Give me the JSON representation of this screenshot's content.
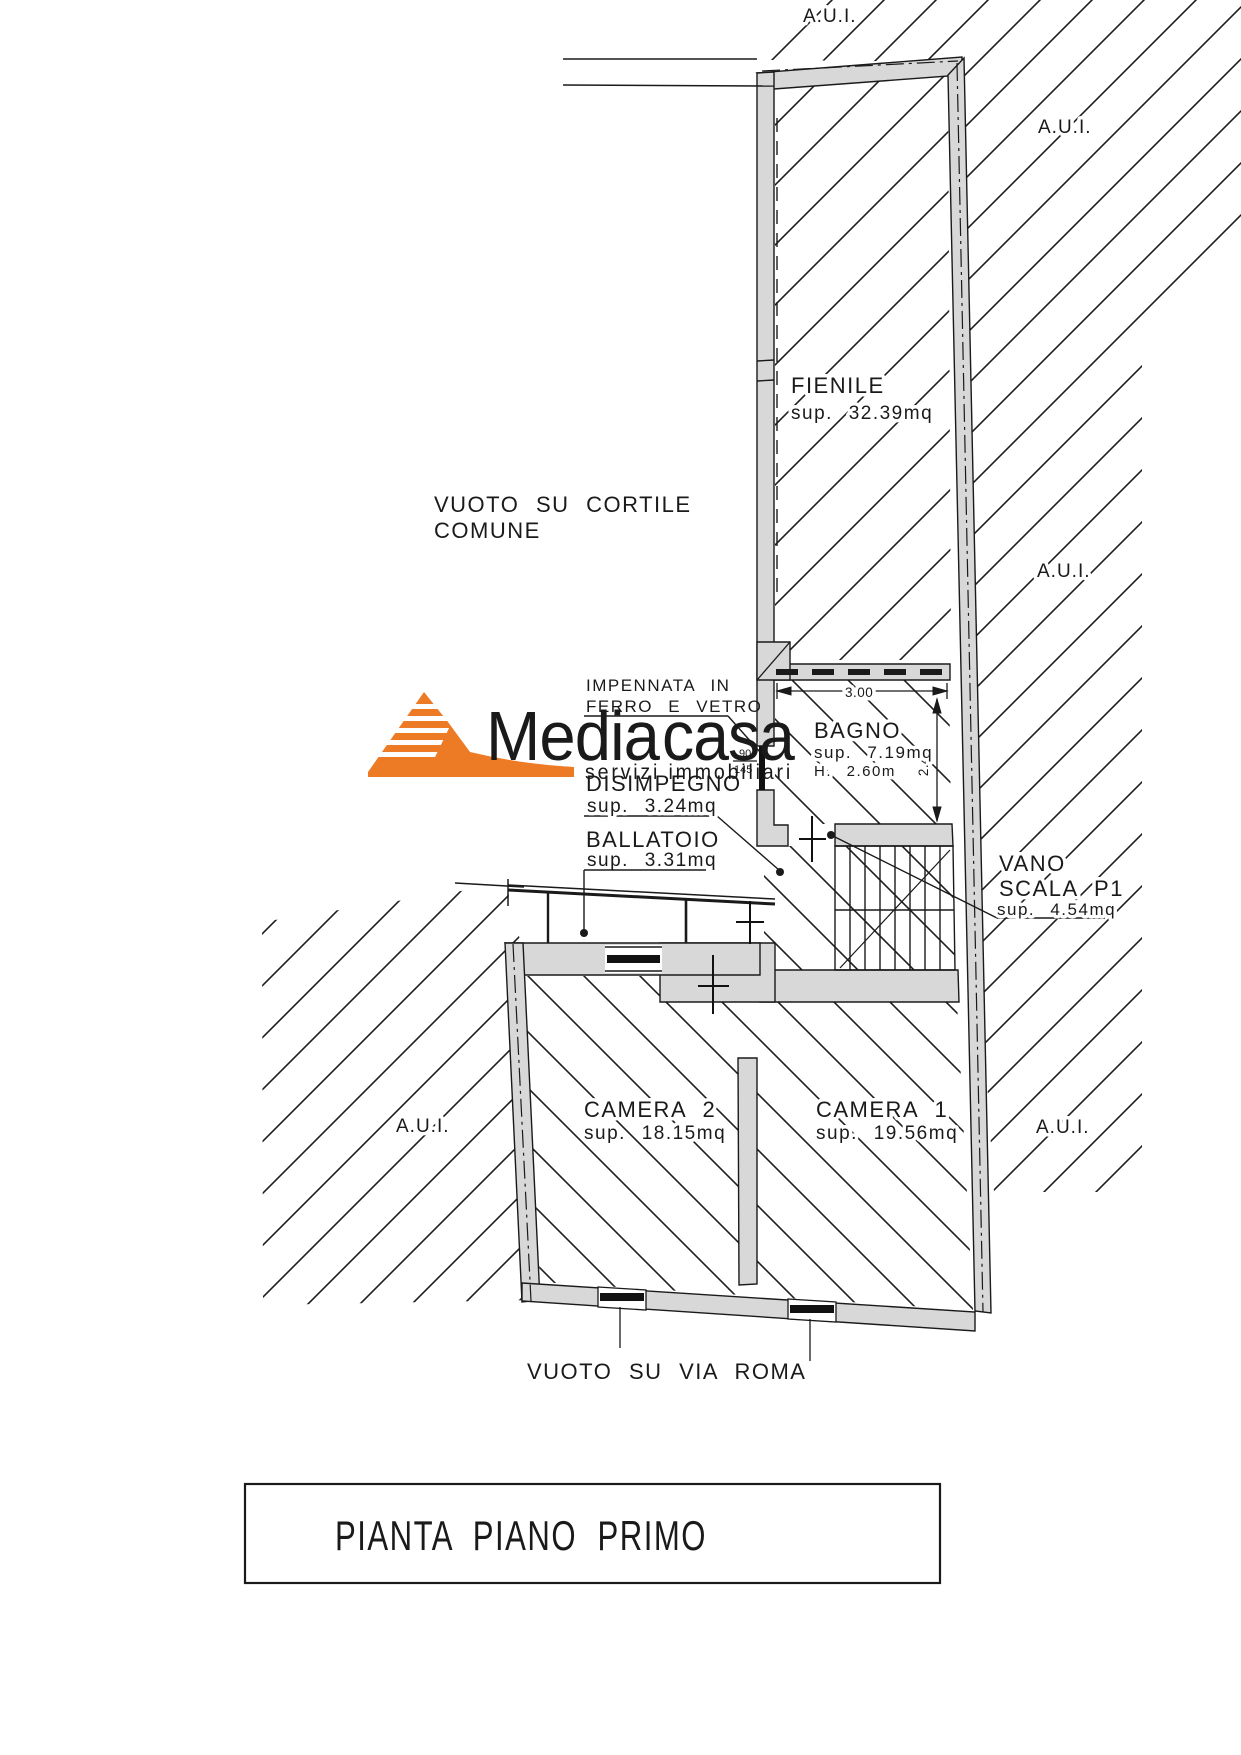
{
  "labels": {
    "aui_top": "A.U.I.",
    "aui_right_upper": "A.U.I.",
    "aui_right_mid": "A.U.I.",
    "aui_right_lower": "A.U.I.",
    "aui_left": "A.U.I.",
    "vuoto_cortile_line1": "VUOTO SU CORTILE",
    "vuoto_cortile_line2": "COMUNE",
    "impennata_line1": "IMPENNATA IN",
    "impennata_line2": "FERRO E VETRO",
    "vuoto_via_roma": "VUOTO SU VIA ROMA"
  },
  "rooms": {
    "fienile": {
      "name": "FIENILE",
      "area": "sup. 32.39mq"
    },
    "bagno": {
      "name": "BAGNO",
      "area": "sup. 7.19mq",
      "height": "H. 2.60m"
    },
    "disimpegno": {
      "name": "DISIMPEGNO",
      "area": "sup. 3.24mq"
    },
    "ballatoio": {
      "name": "BALLATOIO",
      "area": "sup. 3.31mq"
    },
    "vano_scala": {
      "name_line1": "VANO",
      "name_line2": "SCALA P1",
      "area": "sup. 4.54mq"
    },
    "camera2": {
      "name": "CAMERA 2",
      "area": "sup. 18.15mq"
    },
    "camera1": {
      "name": "CAMERA 1",
      "area": "sup. 19.56mq"
    }
  },
  "dimensions": {
    "bagno_width": "3.00",
    "bagno_depth": "2.40",
    "door_width": "90",
    "door_height": "145"
  },
  "logo": {
    "brand_gray": "Media",
    "brand_orange": "casa",
    "tagline": "servizi immobiliari",
    "orange": "#ED7A24",
    "gray": "#8E8E8E",
    "tagline_color": "#F09A55"
  },
  "title": "PIANTA PIANO PRIMO",
  "colors": {
    "wall_fill": "#D8D8D8",
    "line": "#1A1A1A",
    "background": "#FFFFFF"
  }
}
